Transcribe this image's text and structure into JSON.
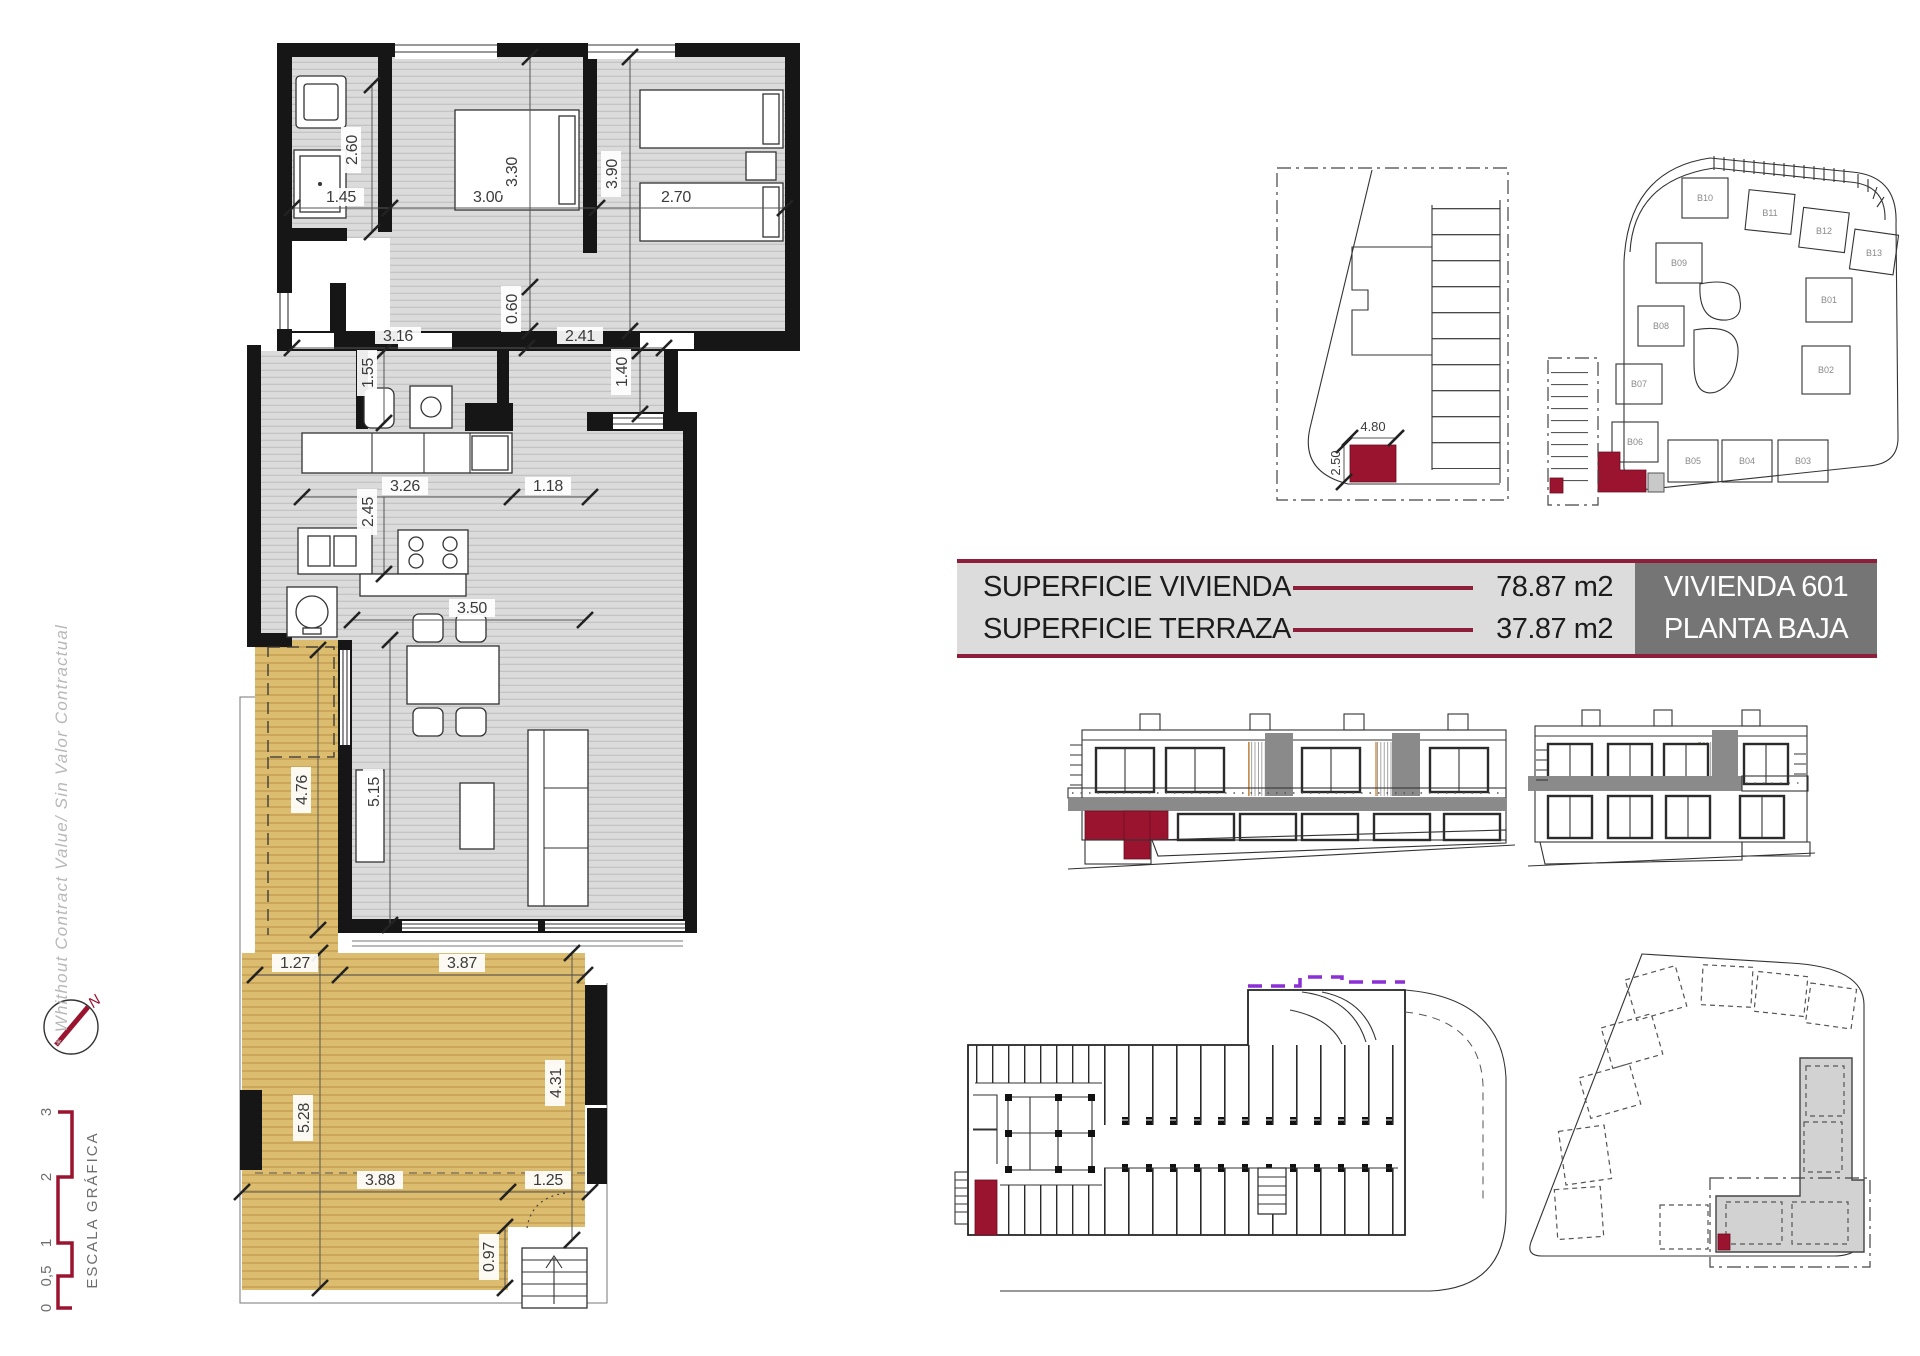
{
  "colors": {
    "maroon": "#9a1430",
    "banner_rule": "#8e1f3a",
    "terrace_tan": "#dcbd70",
    "floor_gray": "#dbdbdb",
    "panel_gray": "#dcdcdc",
    "unit_box_gray": "#757575",
    "purple_dashed": "#8b2fd6",
    "elevation_band_gray": "#8a8a8a"
  },
  "banner": {
    "rows": [
      {
        "label": "SUPERFICIE VIVIENDA",
        "value": "78.87 m2"
      },
      {
        "label": "SUPERFICIE TERRAZA",
        "value": "37.87 m2"
      }
    ],
    "unit": [
      "VIVIENDA 601",
      "PLANTA BAJA"
    ]
  },
  "margin": {
    "disclaimer": "* Whithout Contract Value/ Sin Valor Contractual",
    "north_label": "N",
    "scale_label": "ESCALA GRÁFICA",
    "scale_ticks": [
      "0",
      "0,5",
      "1",
      "2",
      "3"
    ]
  },
  "floorplan": {
    "dims": {
      "bath_h": "2.60",
      "bath_w": "1.45",
      "bed1_w": "3.00",
      "bed1_h": "3.30",
      "bed2_h": "3.90",
      "bed2_w": "2.70",
      "hall_h": "0.60",
      "hall_w1": "3.16",
      "hall_w2": "2.41",
      "wc_h": "1.55",
      "entry_h": "1.40",
      "kitchen_w1": "3.26",
      "kitchen_w2": "1.18",
      "kitchen_h": "2.45",
      "living_w": "3.50",
      "terrace_side": "4.76",
      "living_h": "5.15",
      "terr_w1": "1.27",
      "terr_w2": "3.87",
      "terr_h1": "5.28",
      "terr_h2": "4.31",
      "terr_b1": "3.88",
      "terr_b2": "1.25",
      "terr_s": "0.97"
    }
  },
  "parking": {
    "width": "4.80",
    "depth": "2.50"
  },
  "siteplan": {
    "buildings": [
      "B01",
      "B02",
      "B03",
      "B04",
      "B05",
      "B06",
      "B07",
      "B08",
      "B09",
      "B10",
      "B11",
      "B12",
      "B13"
    ]
  }
}
